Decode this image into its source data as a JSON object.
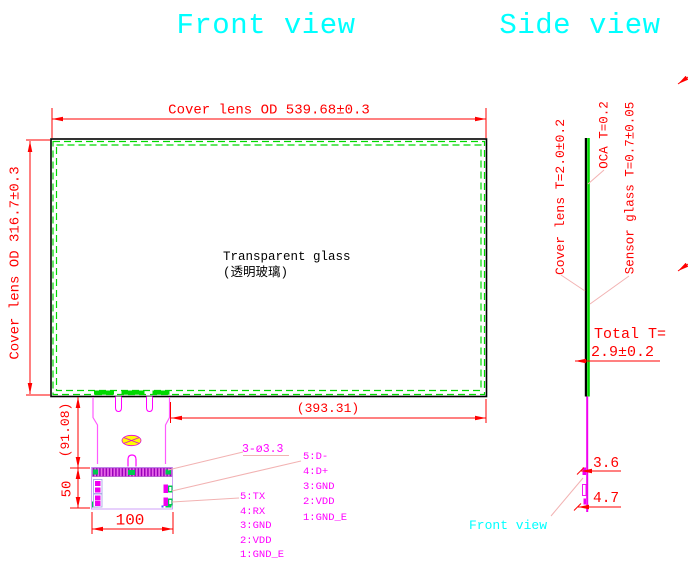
{
  "titles": {
    "front_view": "Front view",
    "side_view": "Side view",
    "front_view_pointer": "Front view"
  },
  "front_view": {
    "dim_width": "Cover lens OD 539.68±0.3",
    "dim_height": "Cover lens OD 316.7±0.3",
    "glass_label_en": "Transparent glass",
    "glass_label_cn": "(透明玻璃)",
    "dim_inner_width": "(393.31)",
    "dim_tail_height": "(91.08)",
    "dim_board_height": "50",
    "dim_board_width": "100",
    "hole_callout": "3-ø3.3",
    "pins_usb": [
      "5:D-",
      "4:D+",
      "3:GND",
      "2:VDD",
      "1:GND_E"
    ],
    "pins_uart": [
      "5:TX",
      "4:RX",
      "3:GND",
      "2:VDD",
      "1:GND_E"
    ]
  },
  "side_view": {
    "cover_lens_label": "Cover lens T=2.0±0.2",
    "oca_label": "OCA T=0.2",
    "sensor_glass_label": "Sensor glass T=0.7±0.05",
    "total_label": "Total T=",
    "total_value": "2.9±0.2",
    "dim_fpc": "3.6",
    "dim_connector": "4.7"
  },
  "colors": {
    "title_cyan": "#00ffff",
    "dimension_red": "#ff0000",
    "leader_pink": "#f2b2b2",
    "glass_green": "#00d800",
    "fpc_magenta": "#ff00ff",
    "board_lavender": "#cfa0f8",
    "logo_yellow": "#ffff00"
  }
}
